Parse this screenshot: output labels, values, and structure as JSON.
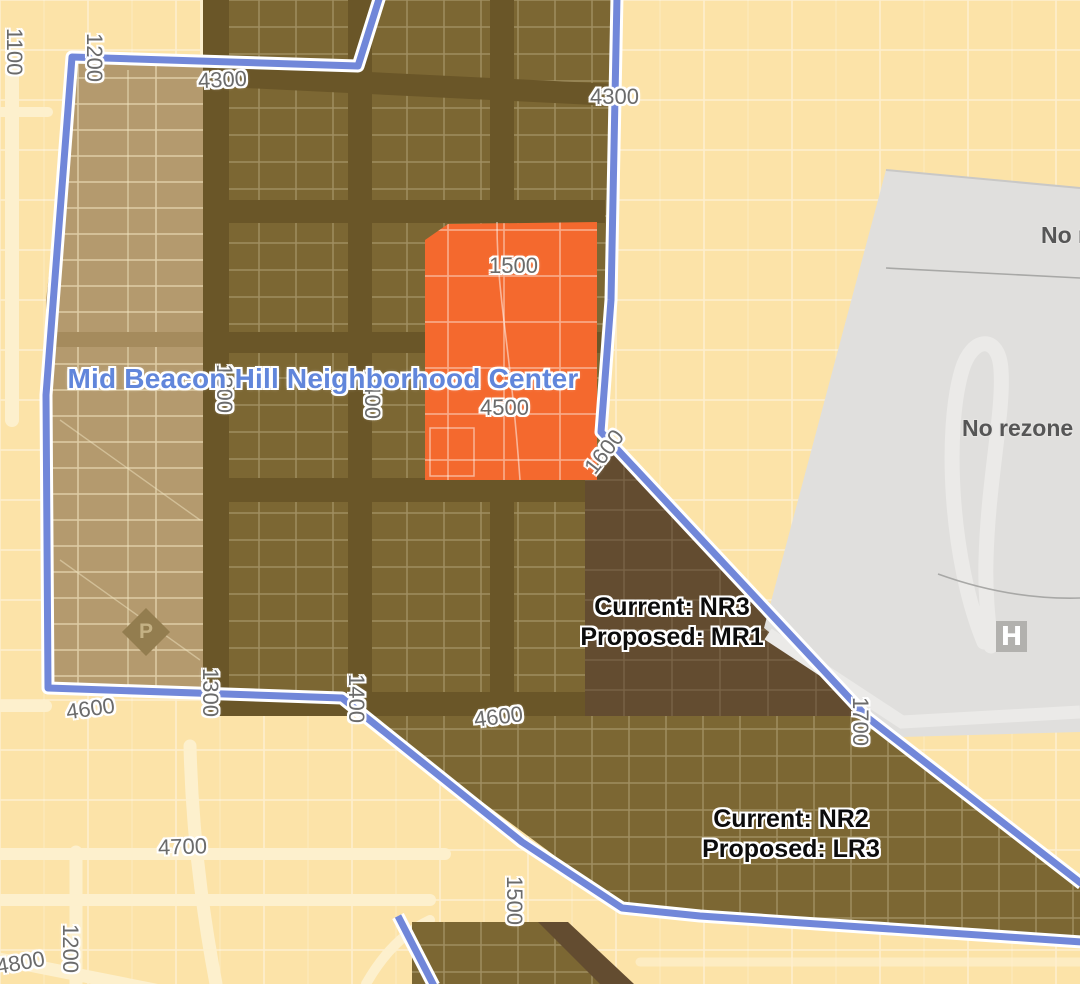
{
  "map": {
    "boundary_title": "Mid Beacon Hill Neighborhood Center",
    "street_labels": [
      {
        "text": "1100",
        "x": 2,
        "y": 28,
        "rot": "v"
      },
      {
        "text": "1200",
        "x": 82,
        "y": 33,
        "rot": "v"
      },
      {
        "text": "4300",
        "x": 198,
        "y": 68,
        "rot": -3
      },
      {
        "text": "4300",
        "x": 590,
        "y": 85,
        "rot": 0
      },
      {
        "text": "1500",
        "x": 489,
        "y": 254,
        "rot": 0
      },
      {
        "text": "4500",
        "x": 480,
        "y": 396,
        "rot": 0
      },
      {
        "text": "1300",
        "x": 212,
        "y": 364,
        "rot": "v"
      },
      {
        "text": "1400",
        "x": 360,
        "y": 370,
        "rot": "v"
      },
      {
        "text": "1600",
        "x": 580,
        "y": 440,
        "rot": -52
      },
      {
        "text": "1300",
        "x": 198,
        "y": 668,
        "rot": "v"
      },
      {
        "text": "1400",
        "x": 344,
        "y": 674,
        "rot": "v"
      },
      {
        "text": "4600",
        "x": 66,
        "y": 697,
        "rot": -8
      },
      {
        "text": "4600",
        "x": 474,
        "y": 705,
        "rot": -7
      },
      {
        "text": "1700",
        "x": 848,
        "y": 697,
        "rot": "v"
      },
      {
        "text": "4700",
        "x": 158,
        "y": 835,
        "rot": -2
      },
      {
        "text": "1500",
        "x": 502,
        "y": 876,
        "rot": "v"
      },
      {
        "text": "1200",
        "x": 58,
        "y": 924,
        "rot": "v"
      },
      {
        "text": "4800",
        "x": -4,
        "y": 951,
        "rot": -10
      }
    ],
    "annotations": [
      {
        "line1": "Current: NR3",
        "line2": "Proposed: MR1",
        "cx": 672,
        "top": 592
      },
      {
        "line1": "Current: NR2",
        "line2": "Proposed: LR3",
        "cx": 791,
        "top": 804
      }
    ],
    "gray_notes": [
      {
        "text": "No r",
        "x": 1041,
        "y": 222
      },
      {
        "text": "No rezone pr",
        "x": 962,
        "y": 415
      }
    ],
    "icons": {
      "hospital_letter": "H",
      "park_letter": "P"
    }
  },
  "colors": {
    "outside_fill": "#fce3a8",
    "road": "#fdf0cd",
    "tan_zone": "#b49a6e",
    "tan_street": "#a58b5d",
    "olive_zone": "#7c6733",
    "olive_street": "#6a5628",
    "dark_zone": "#634c30",
    "orange_zone": "#f4692e",
    "gray_zone": "#e0dfdd",
    "gray_road": "#ebeae8",
    "gray_line": "#a8a8a6",
    "boundary_blue": "#7187d9",
    "boundary_casing": "#ffffff",
    "label_text": "#6b6b6b",
    "title_text": "#6186db",
    "annotation_text": "#0c0c0c",
    "gray_text": "#565656",
    "hospital_icon": "#b2b1ae",
    "park_icon": "#937d4f"
  }
}
